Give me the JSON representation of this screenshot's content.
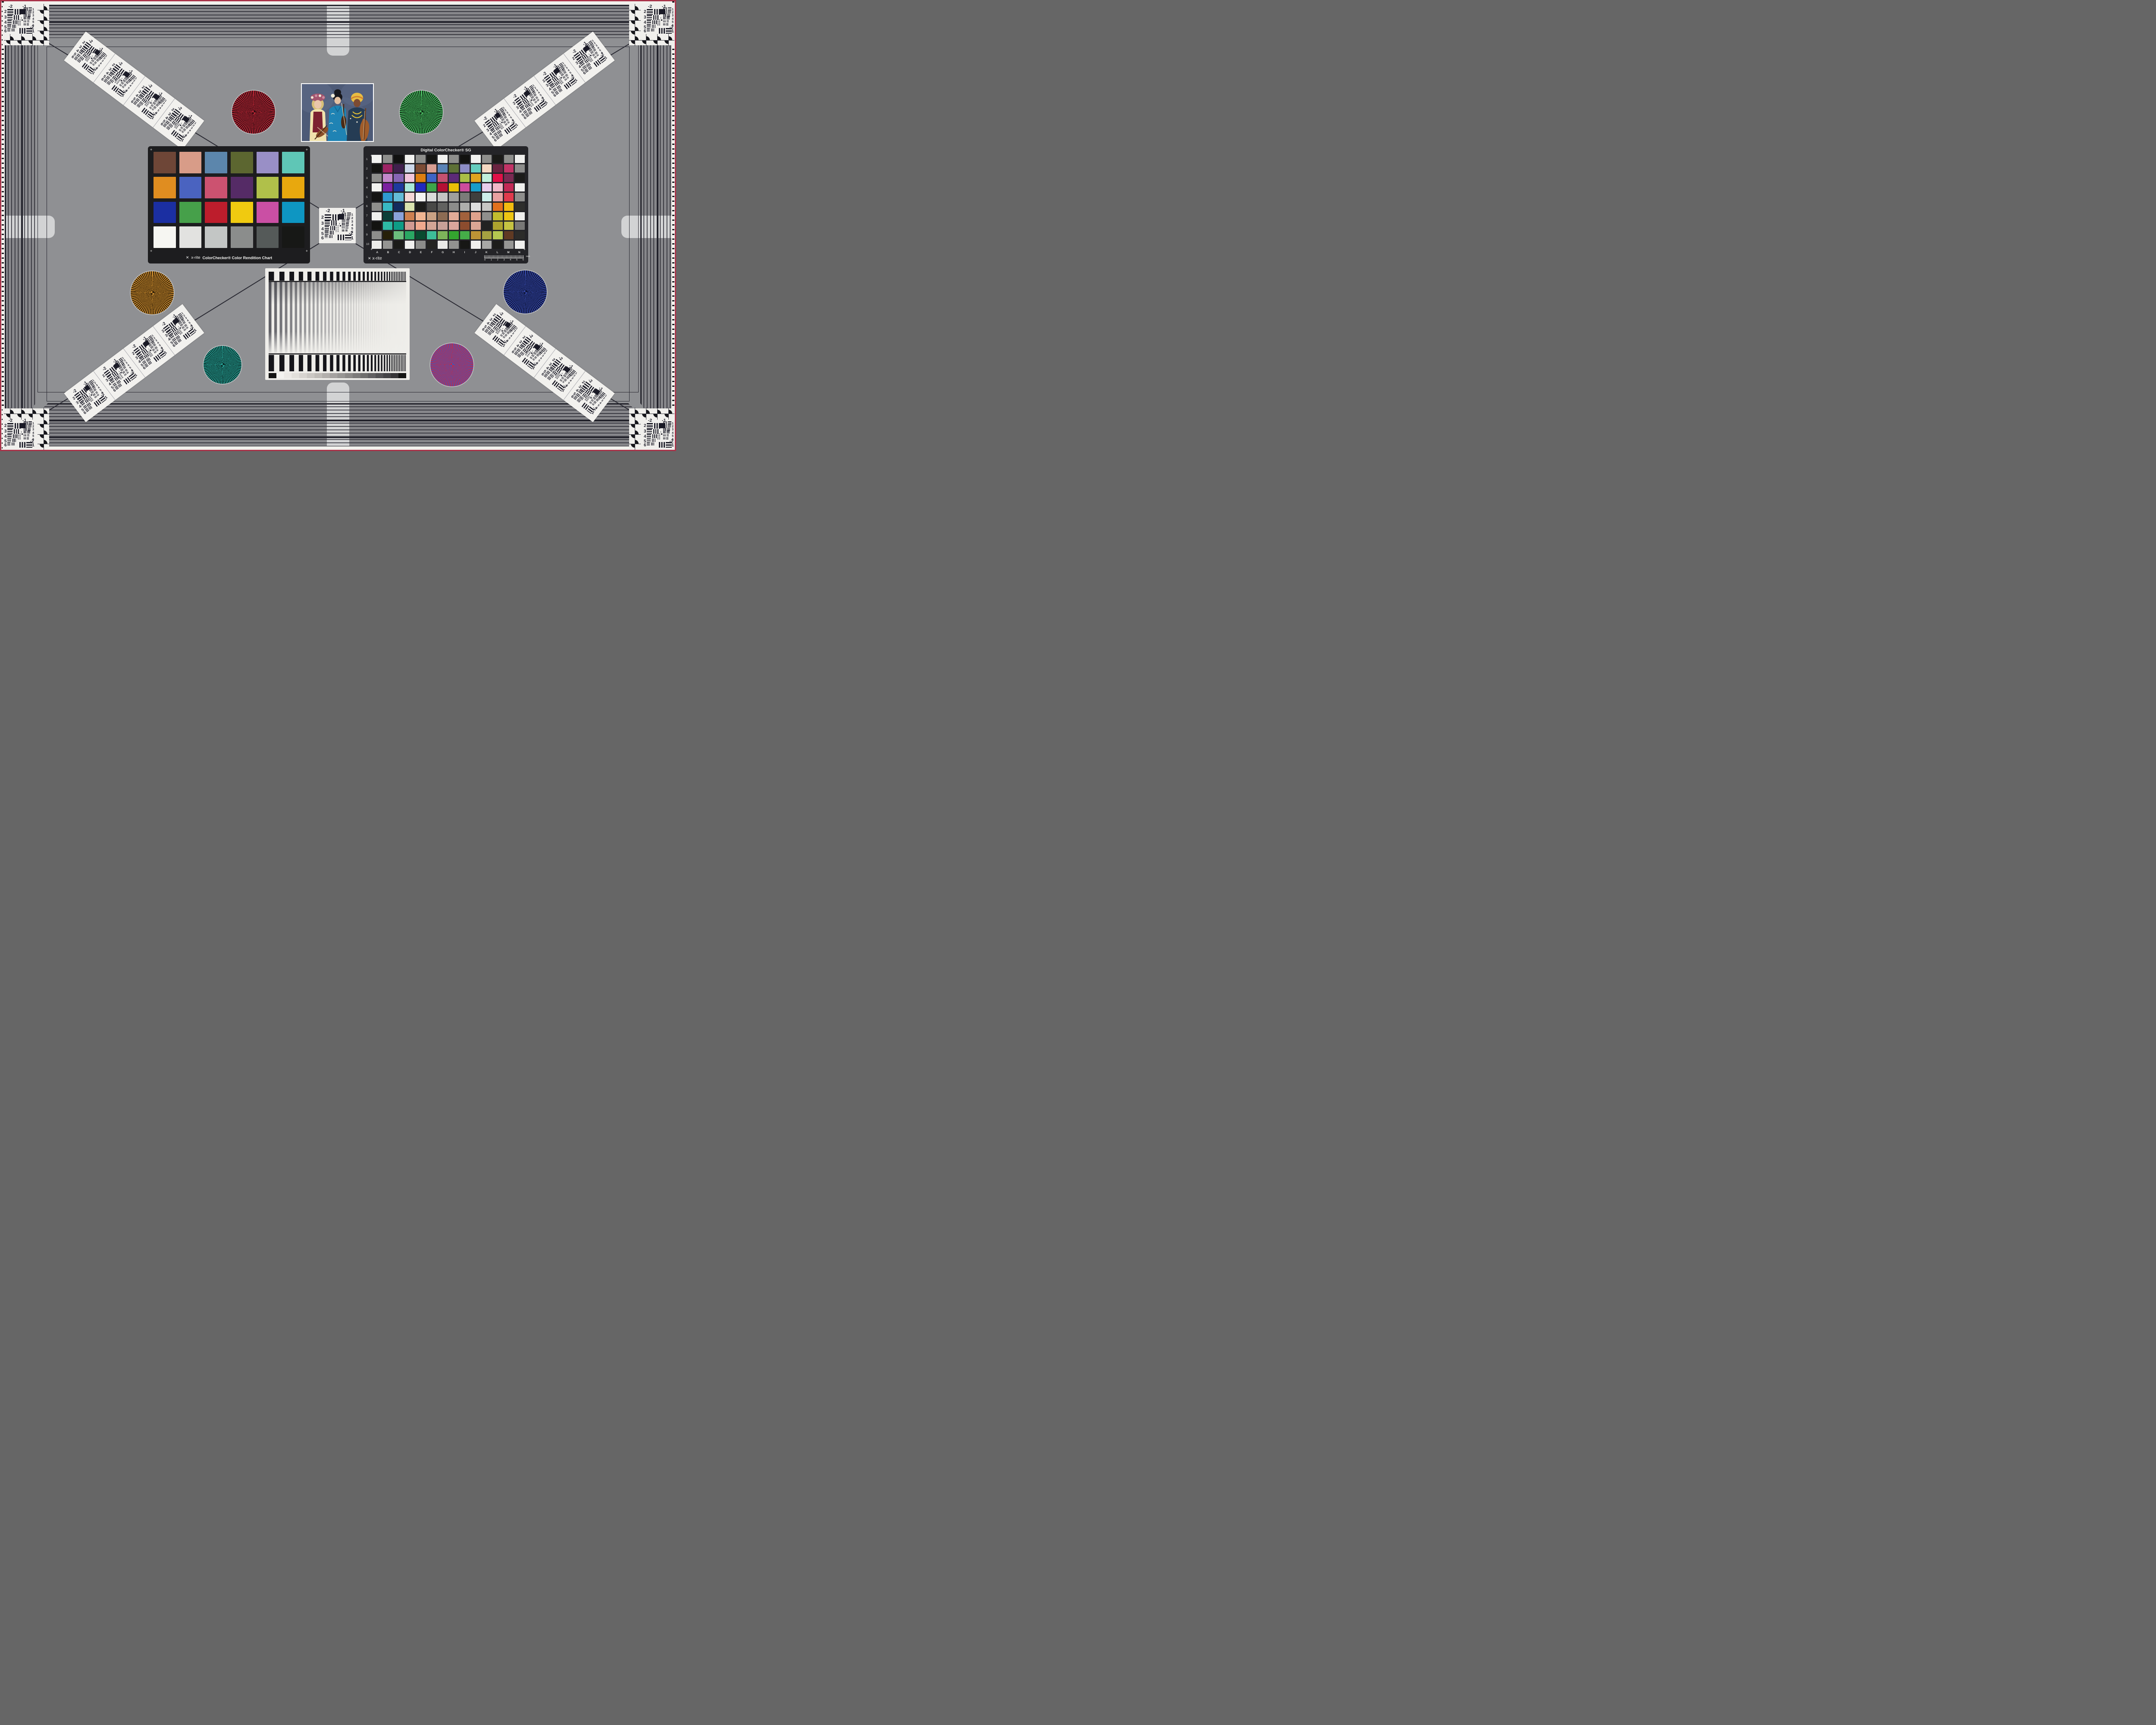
{
  "page": {
    "bg": "#8f9093",
    "band_bg": "#86868a",
    "band_line": "#22222b",
    "frame_line": "#2a2a33",
    "red_border": "#a93349",
    "white_margin": "#f2f1ed",
    "tab": "#d2d3d4",
    "card": "#f0efec",
    "ink": "#1a1a26"
  },
  "usaf": {
    "top_left_label": "-2",
    "top_right_label": "-1",
    "left_labels": [
      "2",
      "3",
      "4",
      "5",
      "6"
    ],
    "right_labels": [
      "1",
      "2",
      "3",
      "4",
      "5",
      "6"
    ],
    "bottom_label_a": "-2",
    "bottom_label_b": "1",
    "micro_labels": [
      "0",
      "1"
    ]
  },
  "colorchecker": {
    "brand": "x-rite",
    "caption": "ColorChecker® Color Rendition Chart",
    "patches": [
      [
        "#6e4637",
        "#d89c88",
        "#5c86ac",
        "#5c6630",
        "#998fc6",
        "#5fc6b6"
      ],
      [
        "#e08d20",
        "#4a63c0",
        "#cc5270",
        "#552b66",
        "#b0c04a",
        "#e8a80e"
      ],
      [
        "#1b2fa2",
        "#46a04a",
        "#bd1d2c",
        "#f0ca10",
        "#ca4fa4",
        "#0e96c2"
      ],
      [
        "#f6f6f2",
        "#e2e2e0",
        "#c3c6c5",
        "#8b8d8c",
        "#555a59",
        "#171816"
      ]
    ]
  },
  "sg": {
    "title": "Digital ColorChecker® SG",
    "brand": "x-rite",
    "row_labels": [
      "1",
      "2",
      "3",
      "4",
      "5",
      "6",
      "7",
      "8",
      "9",
      "10"
    ],
    "col_labels": [
      "A",
      "B",
      "C",
      "D",
      "E",
      "F",
      "G",
      "H",
      "I",
      "J",
      "K",
      "L",
      "M",
      "N"
    ],
    "ruler_ticks": [
      "0",
      "1",
      "2",
      "3",
      "4",
      "5",
      "6"
    ],
    "ruler_unit": "mm",
    "patches": [
      [
        "#f2f2f0",
        "#8e8e8c",
        "#111111",
        "#f2f2f0",
        "#8e8e8c",
        "#141412",
        "#f2f2f0",
        "#8e8e8c",
        "#121210",
        "#f2f2f0",
        "#8e8e8c",
        "#1a1a18",
        "#8e8e8c",
        "#f0f0ee"
      ],
      [
        "#141412",
        "#9e2465",
        "#40204e",
        "#ccd8ea",
        "#7c4c35",
        "#d89e92",
        "#5a83b6",
        "#5d7036",
        "#8c8cc4",
        "#64cdbe",
        "#f4d8c2",
        "#6b2340",
        "#c23366",
        "#8c8c8a"
      ],
      [
        "#8e8e8c",
        "#c287ca",
        "#8765b5",
        "#f2c6dc",
        "#dd7e10",
        "#3e64c6",
        "#c45170",
        "#5c2a78",
        "#aabf46",
        "#dfa41e",
        "#c0efdb",
        "#e01148",
        "#7a2a52",
        "#1c1c1a"
      ],
      [
        "#f2f2f0",
        "#7b20a0",
        "#1d3a9e",
        "#a8e8da",
        "#2029bf",
        "#3da449",
        "#b51034",
        "#e8bf08",
        "#cc4d9d",
        "#189cc8",
        "#e7cdeb",
        "#f2b7c7",
        "#c22955",
        "#f0f0ee"
      ],
      [
        "#141414",
        "#2f9ad0",
        "#64bcd8",
        "#f6d7d6",
        "#f4f4f2",
        "#dbdbd9",
        "#c5c5c3",
        "#9f9f9d",
        "#7b7b79",
        "#3f3f3d",
        "#cdeeea",
        "#e8a1a1",
        "#e03a4c",
        "#8e8e8c"
      ],
      [
        "#8e8e8c",
        "#38b9c3",
        "#132c5e",
        "#d9e3ae",
        "#1b1b19",
        "#494947",
        "#626260",
        "#8c8c8a",
        "#aeaeac",
        "#dedede",
        "#c6c6c4",
        "#e2711e",
        "#f2bb10",
        "#2e2e2c"
      ],
      [
        "#f0f0ee",
        "#0b3f38",
        "#8aa2da",
        "#cd8050",
        "#f0b592",
        "#c9a184",
        "#8c6b53",
        "#e2ab97",
        "#a2613c",
        "#dfa28d",
        "#8f8f8d",
        "#c2bc2e",
        "#ecc513",
        "#efefed"
      ],
      [
        "#131311",
        "#2eb9a5",
        "#0e9c86",
        "#d19a92",
        "#efa98e",
        "#d2a596",
        "#c7a098",
        "#daa69c",
        "#8c4c2e",
        "#daa695",
        "#222222",
        "#ada22e",
        "#c5c342",
        "#787876"
      ],
      [
        "#8e8e8c",
        "#262009",
        "#6cbd7c",
        "#2aa763",
        "#094a2f",
        "#3dbd98",
        "#7db45a",
        "#34a52f",
        "#45ad48",
        "#bd9335",
        "#a5a141",
        "#b4c750",
        "#603a23",
        "#2c2c2a"
      ],
      [
        "#eeeeec",
        "#949492",
        "#1b1b19",
        "#f0f0ee",
        "#8c8c8a",
        "#232321",
        "#eaeae8",
        "#929290",
        "#171715",
        "#f0f0ee",
        "#a8a8a6",
        "#1d1d1b",
        "#969694",
        "#f0f0ee"
      ]
    ]
  },
  "stars": [
    {
      "name": "red-star",
      "c1": "#c22736",
      "c2": "#240a0f"
    },
    {
      "name": "green-star",
      "c1": "#4bbf63",
      "c2": "#0b2611"
    },
    {
      "name": "orange-star",
      "c1": "#cd8d2e",
      "c2": "#2b1b06"
    },
    {
      "name": "blue-star",
      "c1": "#3447a6",
      "c2": "#0b1030"
    },
    {
      "name": "teal-star",
      "c1": "#28a79b",
      "c2": "#07221f"
    },
    {
      "name": "red-blue-star",
      "c1": "#c62a44",
      "c2": "#4853b4"
    }
  ],
  "sweep": {
    "bar_ink": "#15151a",
    "wedge_end": "#141414",
    "wedge_steps": [
      "#f4f3f0",
      "#eceae6",
      "#e2e0db",
      "#d7d4d0",
      "#cbc8c4",
      "#bfbcb8",
      "#b2afac",
      "#a5a2a0",
      "#989694",
      "#8b8987",
      "#7d7b7a",
      "#6f6e6d",
      "#616061",
      "#535254",
      "#454446",
      "#373638"
    ]
  },
  "photo": {
    "backdrop": "#4d5a77",
    "backdrop_light": "#697894",
    "skin_light": "#eac7ab",
    "skin_mid": "#e7c2a2",
    "skin_dark": "#7c4b33",
    "hair_blonde": "#d8c078",
    "hair_black": "#17171d",
    "wreath": "#a4556e",
    "flower_white": "#f0ead8",
    "blouse_yellow": "#f0e2ac",
    "vest_red": "#7c2130",
    "kimono_blue": "#1f83b4",
    "kimono_deep": "#156a96",
    "headwrap_yellow": "#e9bc42",
    "headwrap_orange": "#d08030",
    "outfit_dark": "#253c54",
    "necklace_yellow": "#e7c437",
    "violin_brown": "#8a4f28",
    "violin_dark": "#4a2a16",
    "cello_brown": "#a05c2a",
    "bow_tan": "#d9cba8"
  }
}
